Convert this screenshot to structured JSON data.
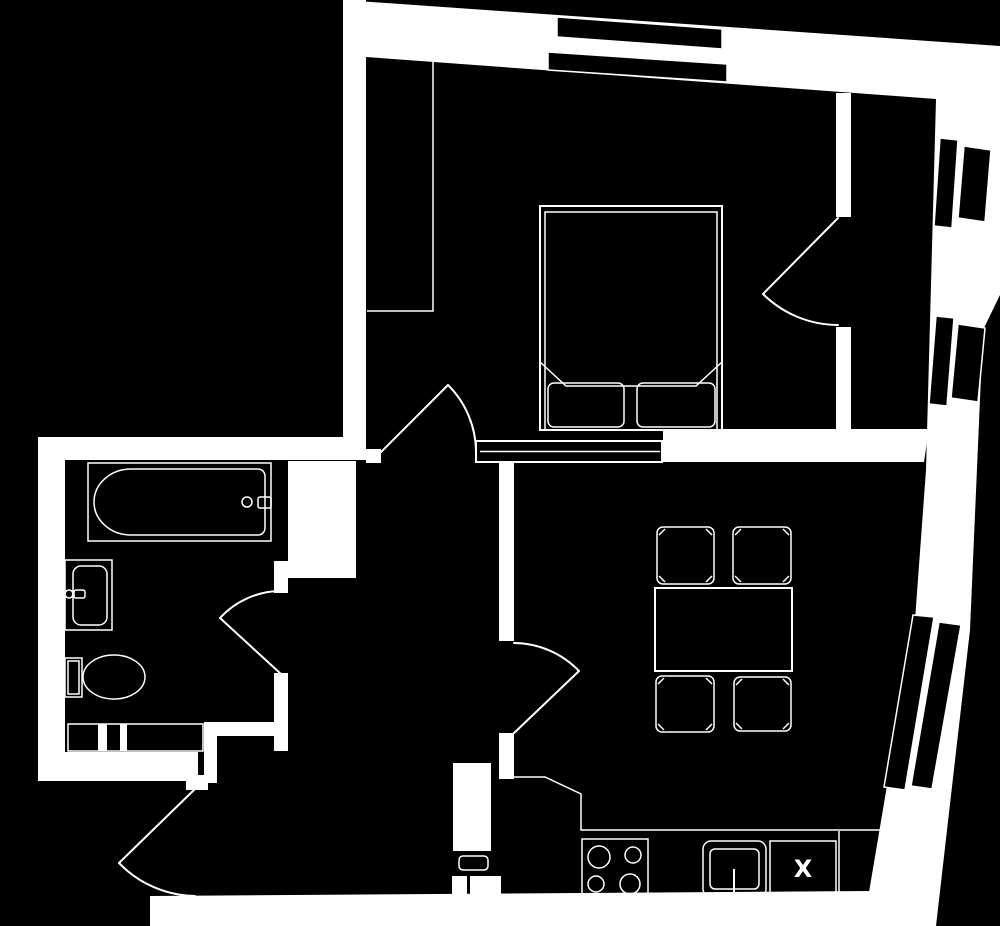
{
  "page": {
    "background": "#000000",
    "line_color": "#ffffff"
  },
  "plan": {
    "appliance_x_label": "X",
    "fixtures": [
      "double-bed",
      "bed-pillows",
      "wardrobe",
      "closet-strip",
      "bathtub",
      "bath-taps",
      "wash-basin",
      "toilet",
      "towel-radiator",
      "dining-table",
      "dining-chairs",
      "kitchen-counter",
      "hob",
      "kitchen-sink",
      "appliance-x",
      "tall-unit",
      "entrance-door",
      "bathroom-door",
      "hall-door",
      "living-room-door",
      "bedroom-door",
      "top-window",
      "side-window-upper",
      "side-window-middle",
      "side-window-lower"
    ]
  }
}
